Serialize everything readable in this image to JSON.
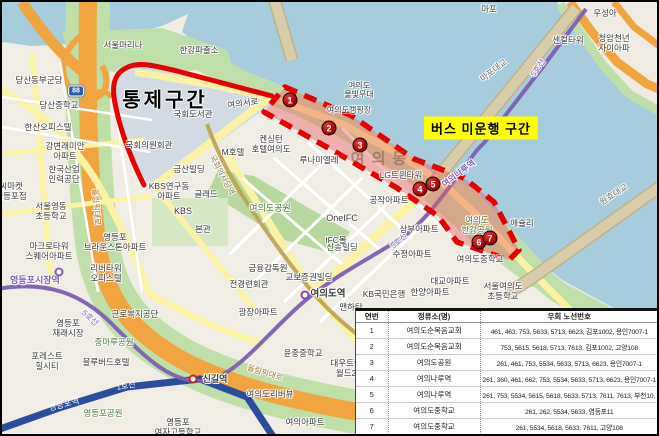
{
  "annotations": {
    "control_zone": "통제구간",
    "no_service": "버스 미운행 구간"
  },
  "detour_table": {
    "headers": [
      "연번",
      "정류소(명)",
      "우회 노선번호"
    ],
    "rows": [
      [
        "1",
        "여의도순복음교회",
        "461, 463, 753, 5633, 5713, 6623, 김포1002, 용인7007-1"
      ],
      [
        "2",
        "여의도순복음교회",
        "753, 5615, 5618, 5713, 7613, 김포1002, 고양108"
      ],
      [
        "3",
        "여의도공원",
        "261, 461, 753, 5534, 5633, 5713, 6623, 용인7007-1"
      ],
      [
        "4",
        "여의나루역",
        "261, 360, 461, 662, 753, 5534, 5633, 5713, 6623, 용인7007-1"
      ],
      [
        "5",
        "여의나루역",
        "261, 753, 5534, 5615, 5618, 5633, 5713, 7611, 7613, 부천10, 영등포10, 고양108"
      ],
      [
        "6",
        "여의도중학교",
        "261, 262, 5534, 5633, 영등포11"
      ],
      [
        "7",
        "여의도중학교",
        "261, 5534, 5618, 5633, 7611, 고양108"
      ]
    ]
  },
  "stop_markers": [
    {
      "n": "1",
      "x": 288,
      "y": 98
    },
    {
      "n": "2",
      "x": 327,
      "y": 126
    },
    {
      "n": "3",
      "x": 358,
      "y": 143
    },
    {
      "n": "4",
      "x": 418,
      "y": 187
    },
    {
      "n": "5",
      "x": 431,
      "y": 182
    },
    {
      "n": "6",
      "x": 477,
      "y": 240
    },
    {
      "n": "7",
      "x": 488,
      "y": 236
    }
  ],
  "station_dots": [
    {
      "name": "여의도역",
      "x": 303,
      "y": 293,
      "line_color": "#8e44ad"
    },
    {
      "name": "신길역",
      "x": 191,
      "y": 377,
      "line_color": "#cc2222"
    },
    {
      "name": "영등포시장역",
      "x": 57,
      "y": 270,
      "line_color": "#7D5FB2"
    }
  ],
  "road_shields": [
    {
      "text": "88",
      "x": 74,
      "y": 89
    }
  ],
  "map_labels": [
    {
      "t": "서울마리나",
      "x": 121,
      "y": 44,
      "s": 8.5
    },
    {
      "t": "한강파출소",
      "x": 197,
      "y": 49,
      "s": 8.5
    },
    {
      "t": "마포",
      "x": 487,
      "y": 8,
      "s": 8.5
    },
    {
      "t": "우성아",
      "x": 603,
      "y": 12,
      "s": 8.5
    },
    {
      "t": "센컬타워",
      "x": 566,
      "y": 39,
      "s": 8.5
    },
    {
      "t": "청암천년\n자이아파",
      "x": 612,
      "y": 42,
      "s": 8.5
    },
    {
      "t": "마포대교",
      "x": 492,
      "y": 69,
      "s": 8.5,
      "c": "#6b6b6b",
      "r": -38
    },
    {
      "t": "원효대교",
      "x": 612,
      "y": 193,
      "s": 8.5,
      "c": "#6b6b6b",
      "r": -33
    },
    {
      "t": "5호선",
      "x": 536,
      "y": 66,
      "s": 8,
      "c": "#7D5FB2",
      "r": -56
    },
    {
      "t": "5호선",
      "x": 397,
      "y": 239,
      "s": 8,
      "c": "#7D5FB2",
      "r": -40
    },
    {
      "t": "5호선",
      "x": 88,
      "y": 316,
      "s": 8,
      "c": "#7D5FB2",
      "r": 42
    },
    {
      "t": "여의도\n물빛무대",
      "x": 357,
      "y": 88,
      "s": 8
    },
    {
      "t": "여의도캠핑장",
      "x": 347,
      "y": 108,
      "s": 8
    },
    {
      "t": "여의서로",
      "x": 241,
      "y": 102,
      "s": 8.5,
      "r": -8
    },
    {
      "t": "국회도서관",
      "x": 191,
      "y": 113,
      "s": 8.5
    },
    {
      "t": "국회의원회관",
      "x": 147,
      "y": 144,
      "s": 8.5
    },
    {
      "t": "국회의사당역",
      "x": 220,
      "y": 173,
      "s": 8,
      "c": "#8a7a45",
      "r": 62
    },
    {
      "t": "금산빌딩",
      "x": 187,
      "y": 168,
      "s": 8.5
    },
    {
      "t": "KBS연구동\n아파트",
      "x": 167,
      "y": 190,
      "s": 8.5
    },
    {
      "t": "글래드",
      "x": 204,
      "y": 193,
      "s": 8.5
    },
    {
      "t": "KBS",
      "x": 181,
      "y": 209,
      "s": 9
    },
    {
      "t": "본관",
      "x": 201,
      "y": 228,
      "s": 8.5
    },
    {
      "t": "여의도공원",
      "x": 268,
      "y": 206,
      "s": 9,
      "c": "#4a7a33"
    },
    {
      "t": "M호텔",
      "x": 231,
      "y": 151,
      "s": 8.5
    },
    {
      "t": "켄싱턴\n호텔여의도",
      "x": 269,
      "y": 143,
      "s": 8.5
    },
    {
      "t": "루나미엘레",
      "x": 317,
      "y": 159,
      "s": 8.5
    },
    {
      "t": "LG트윈타워",
      "x": 399,
      "y": 174,
      "s": 8.5
    },
    {
      "t": "공작아파트",
      "x": 387,
      "y": 199,
      "s": 8.5
    },
    {
      "t": "여의나루역",
      "x": 457,
      "y": 172,
      "s": 8.5,
      "c": "#7D5FB2",
      "r": -37,
      "w": 700
    },
    {
      "t": "여의도\n한강공원",
      "x": 475,
      "y": 224,
      "s": 8.5,
      "c": "#4a7a33"
    },
    {
      "t": "애슐리",
      "x": 520,
      "y": 222,
      "s": 8.5
    },
    {
      "t": "삼부아파트",
      "x": 417,
      "y": 228,
      "s": 8.5
    },
    {
      "t": "수정아파트",
      "x": 410,
      "y": 253,
      "s": 8.5
    },
    {
      "t": "신송빌딩",
      "x": 340,
      "y": 246,
      "s": 8.5
    },
    {
      "t": "OneIFC",
      "x": 340,
      "y": 216,
      "s": 9
    },
    {
      "t": "IFC몰",
      "x": 334,
      "y": 239,
      "s": 8.5
    },
    {
      "t": "금융감독원",
      "x": 266,
      "y": 267,
      "s": 8.5
    },
    {
      "t": "전경련회관",
      "x": 247,
      "y": 283,
      "s": 8.5
    },
    {
      "t": "교보증권빌딩",
      "x": 307,
      "y": 276,
      "s": 8.5
    },
    {
      "t": "여의도역",
      "x": 326,
      "y": 293,
      "s": 9.5,
      "w": 700
    },
    {
      "t": "KB국민은행",
      "x": 382,
      "y": 293,
      "s": 8.5
    },
    {
      "t": "한양아파트",
      "x": 428,
      "y": 291,
      "s": 8.5
    },
    {
      "t": "대교아파트",
      "x": 448,
      "y": 280,
      "s": 8.5
    },
    {
      "t": "여의도중학교",
      "x": 478,
      "y": 258,
      "s": 8.5
    },
    {
      "t": "서울여의도\n초등학교",
      "x": 501,
      "y": 290,
      "s": 8.5
    },
    {
      "t": "맨하탄",
      "x": 349,
      "y": 306,
      "s": 8.5
    },
    {
      "t": "광장아파트",
      "x": 256,
      "y": 311,
      "s": 8.5
    },
    {
      "t": "윤중중학교",
      "x": 301,
      "y": 352,
      "s": 8.5
    },
    {
      "t": "대우트럼프\n월드2차",
      "x": 348,
      "y": 367,
      "s": 8.5
    },
    {
      "t": "여의도리버뷰",
      "x": 268,
      "y": 393,
      "s": 8.5
    },
    {
      "t": "여의아파트",
      "x": 303,
      "y": 421,
      "s": 8.5
    },
    {
      "t": "영등포시장역",
      "x": 33,
      "y": 278,
      "s": 9,
      "c": "#7D5FB2",
      "w": 700
    },
    {
      "t": "신길역",
      "x": 213,
      "y": 377,
      "s": 9,
      "w": 700
    },
    {
      "t": "1호선",
      "x": 124,
      "y": 384,
      "s": 8,
      "c": "#ffffff",
      "halo": 0,
      "r": -9
    },
    {
      "t": "영등포역",
      "x": 62,
      "y": 403,
      "s": 8.5,
      "c": "#ffffff",
      "halo": 0,
      "r": -14
    },
    {
      "t": "영등포공원",
      "x": 101,
      "y": 412,
      "s": 8.5,
      "c": "#4a7a33"
    },
    {
      "t": "영등포\n여자고등학교",
      "x": 176,
      "y": 426,
      "s": 8.5
    },
    {
      "t": "중마루공원",
      "x": 112,
      "y": 341,
      "s": 8.5,
      "c": "#4a7a33"
    },
    {
      "t": "근로복지공단",
      "x": 133,
      "y": 313,
      "s": 8.5
    },
    {
      "t": "영등포\n재래시장",
      "x": 66,
      "y": 327,
      "s": 8.5
    },
    {
      "t": "포레스트\n힐시티",
      "x": 45,
      "y": 360,
      "s": 8.5
    },
    {
      "t": "블루버드호텔",
      "x": 104,
      "y": 361,
      "s": 8.5
    },
    {
      "t": "마크로타워\n스퀘어아파트",
      "x": 47,
      "y": 250,
      "s": 8.5
    },
    {
      "t": "서울영동\n초등학교",
      "x": 49,
      "y": 210,
      "s": 8.5
    },
    {
      "t": "씨마켓\n영등포점",
      "x": 9,
      "y": 190,
      "s": 8.5
    },
    {
      "t": "한국산업\n인력공단",
      "x": 62,
      "y": 173,
      "s": 8.5
    },
    {
      "t": "강변래미안\n아파트",
      "x": 63,
      "y": 150,
      "s": 8.5
    },
    {
      "t": "한산오피스텔",
      "x": 46,
      "y": 126,
      "s": 8.5
    },
    {
      "t": "당산중학교",
      "x": 57,
      "y": 104,
      "s": 8.5
    },
    {
      "t": "당산동부군당",
      "x": 37,
      "y": 79,
      "s": 8.5
    },
    {
      "t": "영등포\n브라운스톤아파트",
      "x": 113,
      "y": 241,
      "s": 8.5
    },
    {
      "t": "리버타워\n오피스텔",
      "x": 104,
      "y": 272,
      "s": 8.5
    },
    {
      "t": "올림픽대로",
      "x": 263,
      "y": 371,
      "s": 8,
      "c": "#a8762e",
      "r": 17
    },
    {
      "t": "올림픽대로",
      "x": 94,
      "y": 205,
      "s": 8,
      "c": "#a8762e",
      "r": 86
    },
    {
      "t": "여의동",
      "x": 380,
      "y": 157,
      "s": 15,
      "c": "rgba(130,95,80,0.6)",
      "w": 700,
      "sp": 7,
      "halo": 0
    }
  ],
  "colors": {
    "water": "#A6CDDE",
    "park_green": "#BFDFA9",
    "district_blue": "#D2DAE3",
    "road_yellow": "#FBF3A3",
    "highway_orange": "#F2A43F",
    "bridge_tan": "#D9CDA9",
    "line1_blue": "#2A4DA0",
    "line5_purple": "#7D5FB2",
    "line9_gold": "#BDA14D",
    "alert_red": "#E60000",
    "zone_fill": "rgba(236,92,92,0.42)",
    "notice_yellow": "#FFFF00"
  }
}
